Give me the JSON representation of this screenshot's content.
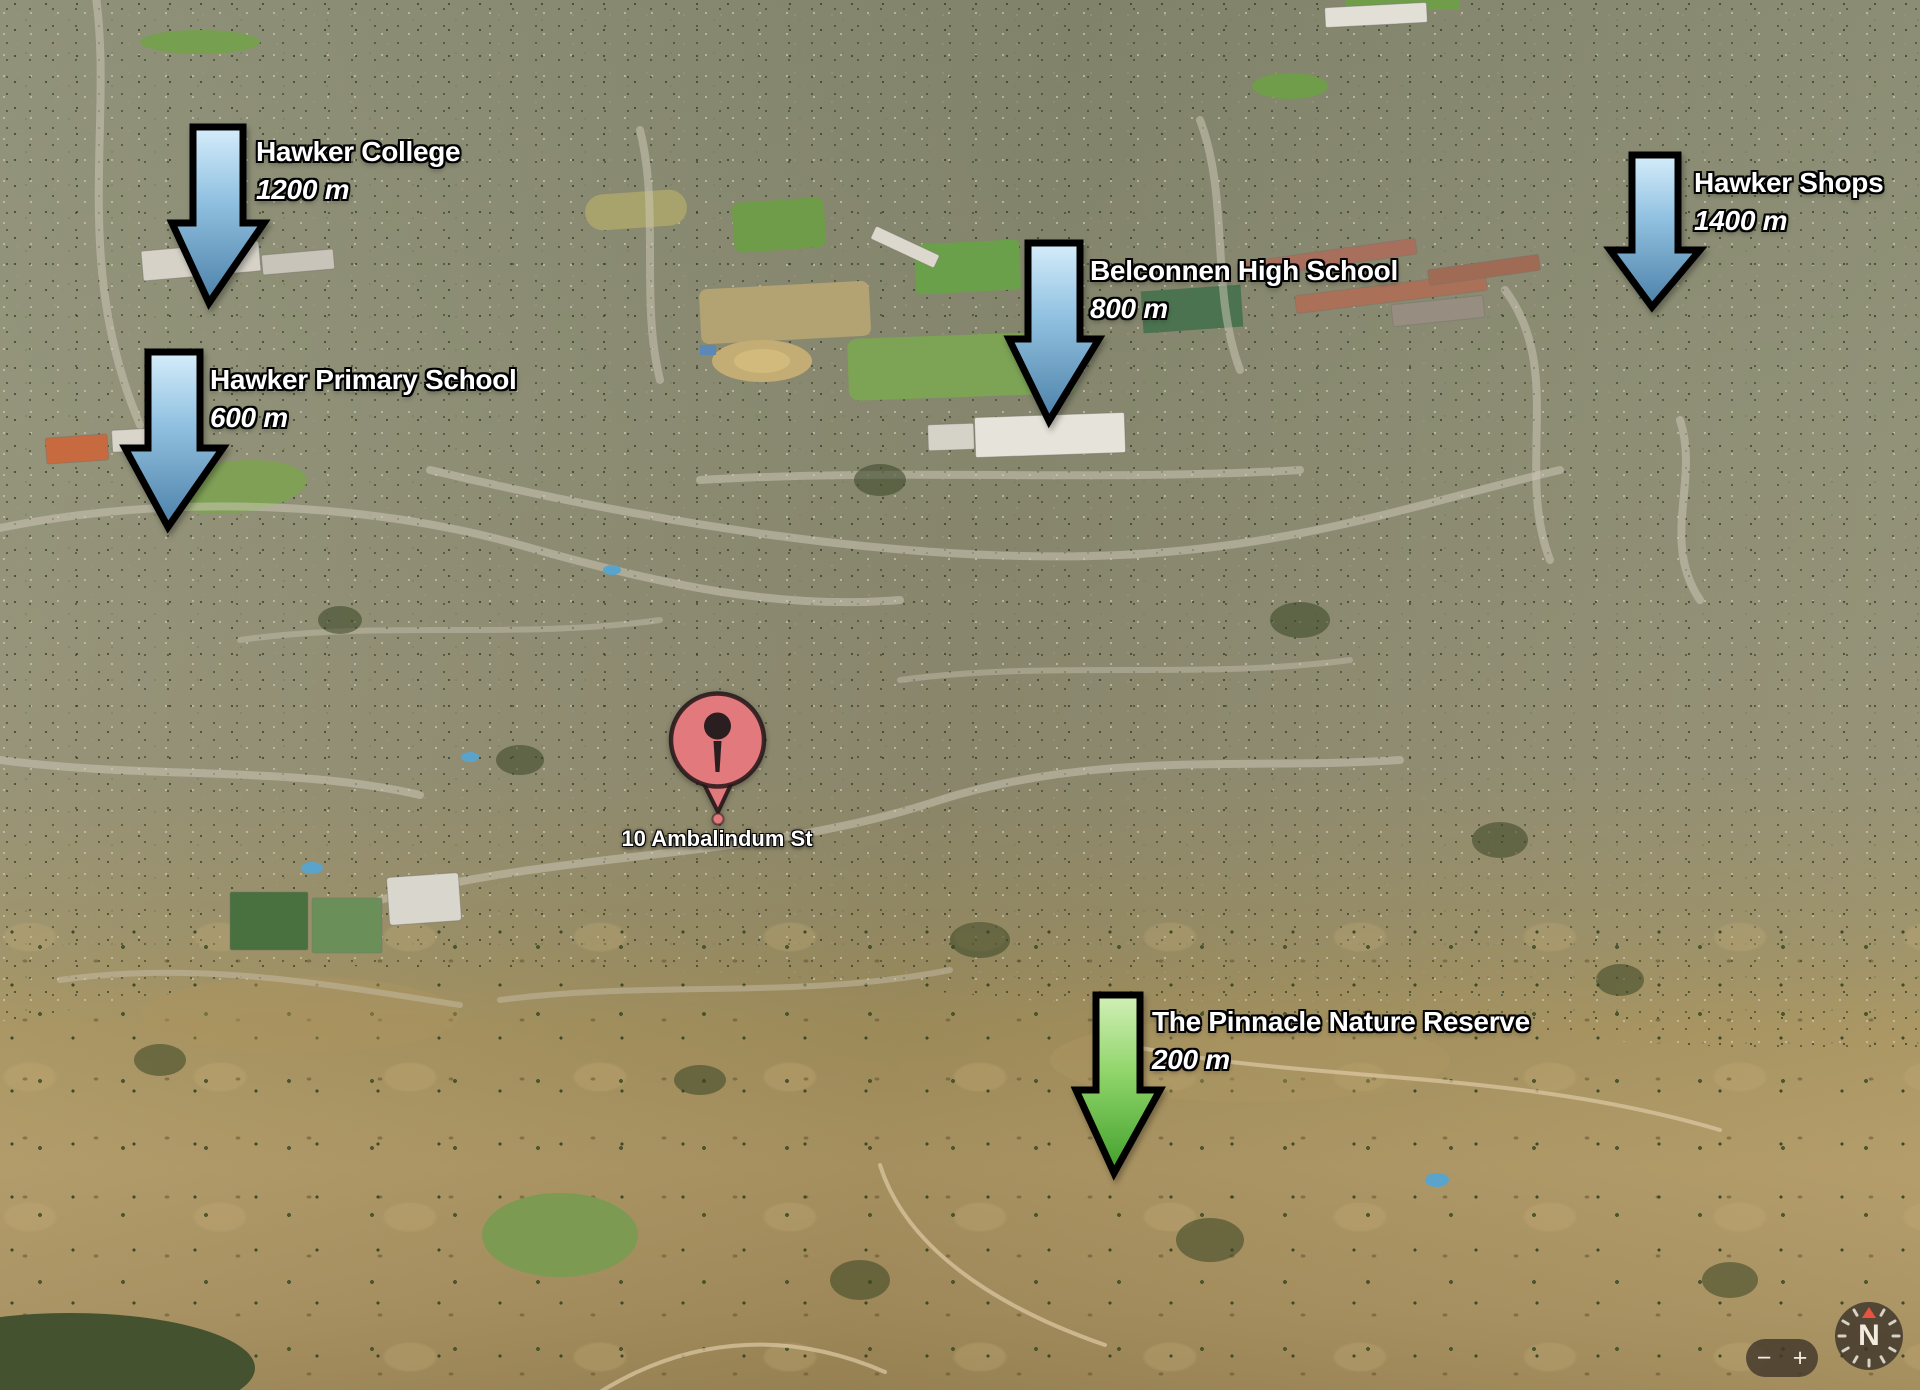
{
  "annotations": [
    {
      "name": "Hawker College",
      "distance": "1200 m",
      "arrow_color": "blue"
    },
    {
      "name": "Hawker Primary School",
      "distance": "600 m",
      "arrow_color": "blue"
    },
    {
      "name": "Belconnen High School",
      "distance": "800 m",
      "arrow_color": "blue"
    },
    {
      "name": "Hawker Shops",
      "distance": "1400 m",
      "arrow_color": "blue"
    },
    {
      "name": "The Pinnacle Nature Reserve",
      "distance": "200 m",
      "arrow_color": "green"
    }
  ],
  "pin": {
    "label": "10 Ambalindum St",
    "color": "#e2797d",
    "glyph_color": "#2a1e21"
  },
  "controls": {
    "zoom_out": "−",
    "zoom_in": "+",
    "compass_north": "N"
  },
  "colors": {
    "arrow_blue_light": "#d6edfb",
    "arrow_blue_mid": "#93c3e2",
    "arrow_blue_dark": "#4c80a8",
    "arrow_green_light": "#d2f0b7",
    "arrow_green_mid": "#8ed468",
    "arrow_green_dark": "#419f2b",
    "arrow_outline": "#000000",
    "label_text": "#ffffff",
    "compass_needle": "#e85340"
  }
}
